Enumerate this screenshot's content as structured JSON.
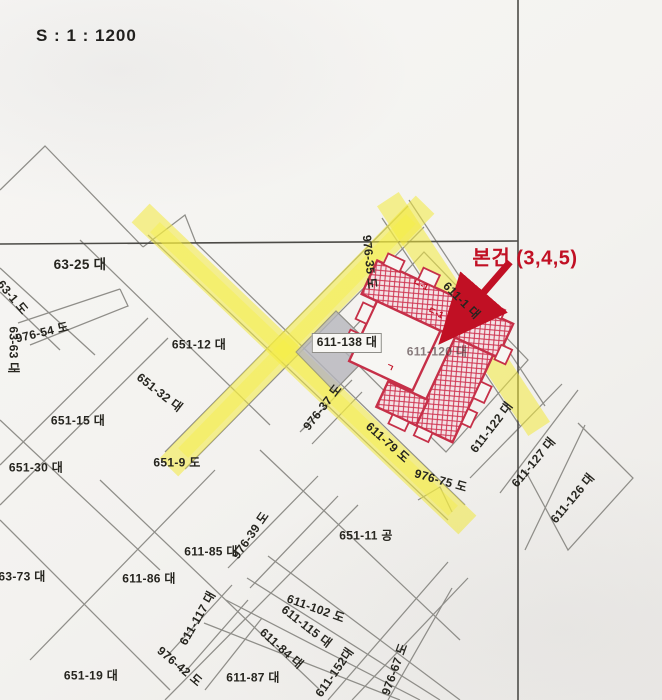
{
  "scale": {
    "text": "S : 1 : 1200"
  },
  "annotation": {
    "subject_label": "본건 (3,4,5)",
    "arrow": "red arrow pointing to subject parcel"
  },
  "colors": {
    "highlight_yellow": "#f2e93c",
    "subject_red": "#c11024",
    "hatch_red": "#cf3552",
    "boundary_gray": "#8f8e89",
    "paper": "#f5f4f1",
    "gray_parcel": "#b6b6bd"
  },
  "parcels": [
    {
      "text": "63-25 대"
    },
    {
      "text": "63-1 도"
    },
    {
      "text": "976-54 도"
    },
    {
      "text": "63-63 대"
    },
    {
      "text": "651-12 대"
    },
    {
      "text": "651-32 대"
    },
    {
      "text": "651-15 대"
    },
    {
      "text": "651-30 대"
    },
    {
      "text": "651-9 도"
    },
    {
      "text": "611-138 대"
    },
    {
      "text": "976-35 도"
    },
    {
      "text": "611-1 대"
    },
    {
      "text": "611-120 대"
    },
    {
      "text": "611-79 도"
    },
    {
      "text": "976-75 도"
    },
    {
      "text": "976-37 도"
    },
    {
      "text": "611-122 대"
    },
    {
      "text": "611-127 대"
    },
    {
      "text": "611-126 대"
    },
    {
      "text": "651-11 공"
    },
    {
      "text": "611-85 대"
    },
    {
      "text": "976-39 도"
    },
    {
      "text": "611-86 대"
    },
    {
      "text": "63-73 대"
    },
    {
      "text": "611-102 도"
    },
    {
      "text": "611-115 대"
    },
    {
      "text": "611-84 대"
    },
    {
      "text": "611-117 대"
    },
    {
      "text": "976-42 도"
    },
    {
      "text": "651-19 대"
    },
    {
      "text": "611-87 대"
    },
    {
      "text": "611-152대"
    },
    {
      "text": "976-67 도"
    }
  ],
  "building_marks": [
    {
      "text": "ㄱ"
    },
    {
      "text": "ㄴ-1"
    },
    {
      "text": "ㄷ-1"
    }
  ]
}
